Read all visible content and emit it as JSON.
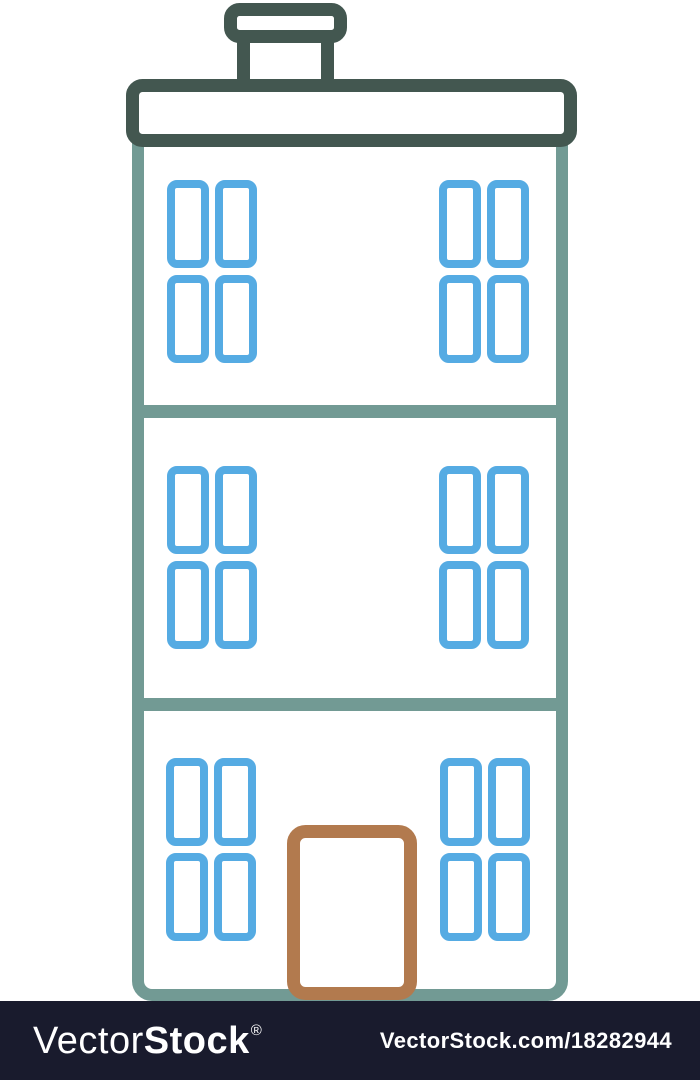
{
  "illustration": {
    "name": "three-story-apartment-building-line-art",
    "floors": 3,
    "windows": 6,
    "panes_per_window": 4
  },
  "colors": {
    "outline_dark": "#435750",
    "wall": "#729a94",
    "window": "#55abe3",
    "door": "#b27a4e",
    "footer_bg": "#191b2d",
    "canvas_bg": "#ffffff",
    "text": "#ffffff"
  },
  "watermark": {
    "brand_light": "Vector",
    "brand_bold": "Stock",
    "registered": "®",
    "url": "VectorStock.com/18282944"
  }
}
